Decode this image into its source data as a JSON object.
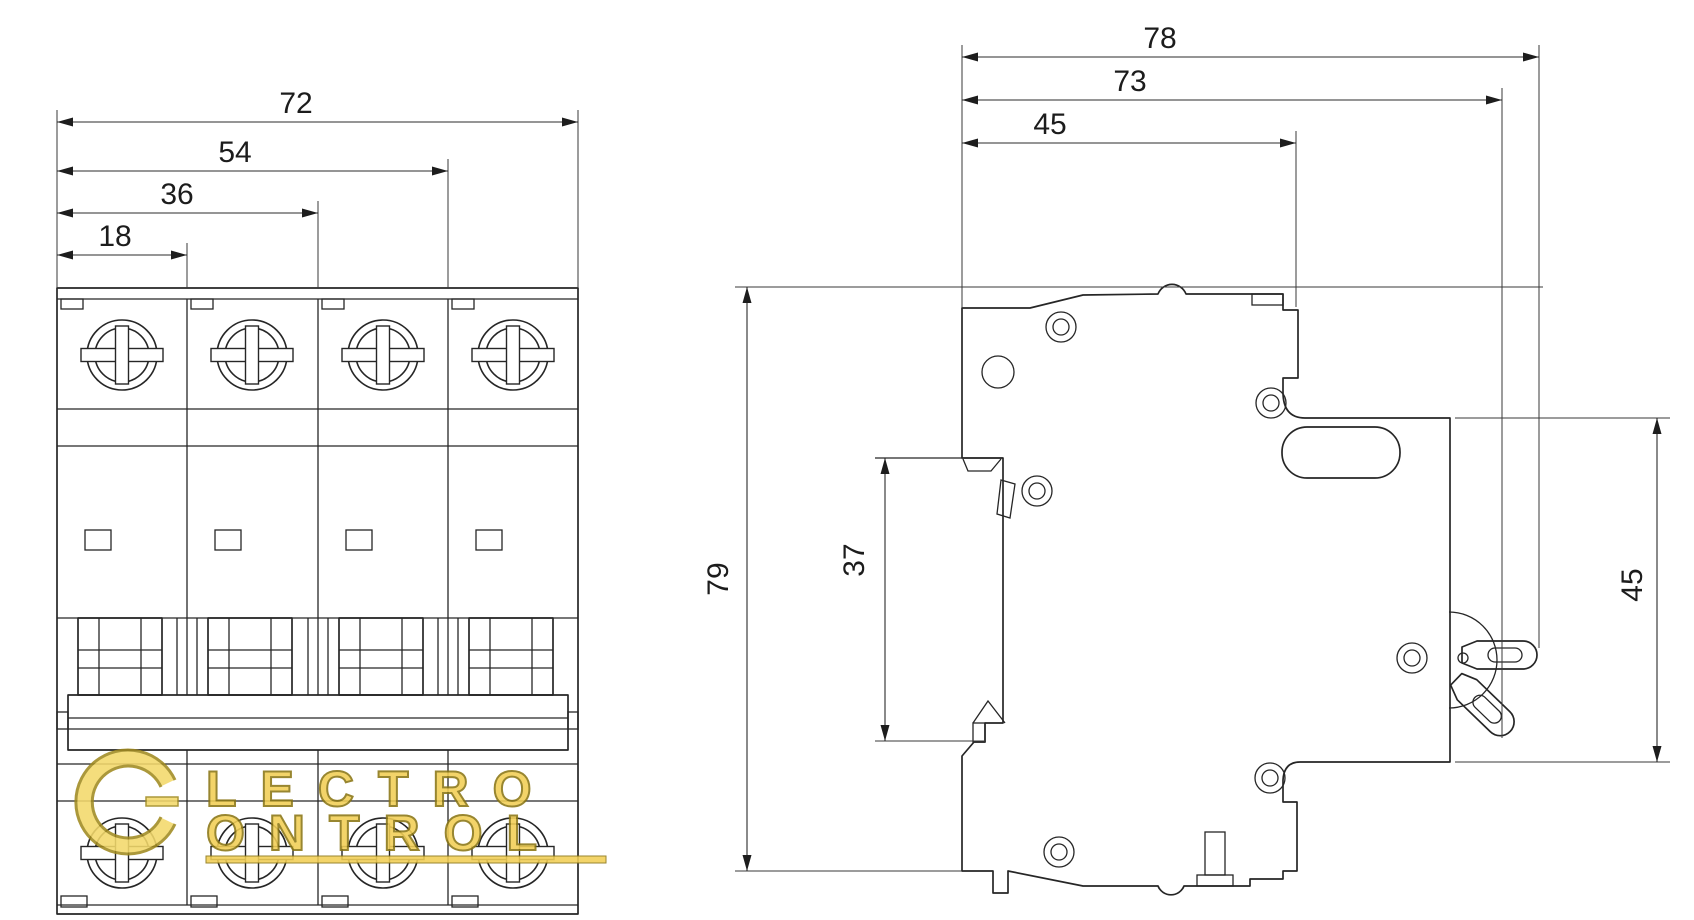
{
  "page": {
    "background_color": "#ffffff",
    "line_color": "#262626",
    "drawing_type": "circuit breaker dimensional drawing, front and side views"
  },
  "views": {
    "front": {
      "title": "front view (4-pole breaker)",
      "dims": [
        {
          "label": "72"
        },
        {
          "label": "54"
        },
        {
          "label": "36"
        },
        {
          "label": "18"
        }
      ]
    },
    "side": {
      "title": "side view (DIN rail profile)",
      "dims_top": [
        {
          "label": "78"
        },
        {
          "label": "73"
        },
        {
          "label": "45"
        }
      ],
      "dim_height": {
        "label": "79"
      },
      "dim_clip": {
        "label": "37"
      },
      "dim_right": {
        "label": "45"
      }
    }
  },
  "watermark": {
    "text_line1": "LECTRO",
    "text_line2": "ONTROL",
    "fill_color": "#f2cf55",
    "outline_color": "#8a7614",
    "accent_color": "#f3d96b"
  }
}
